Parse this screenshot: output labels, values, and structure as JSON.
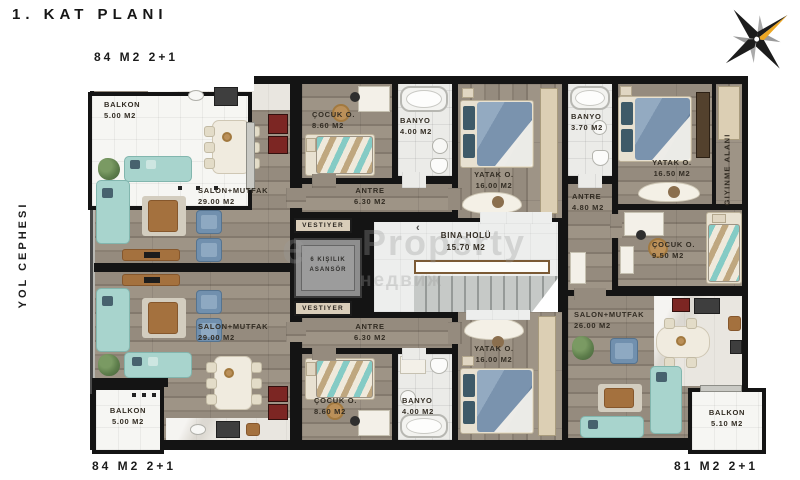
{
  "title": "1. KAT PLANI",
  "side_label": "YOL CEPHESI",
  "apartment_labels": {
    "top_left": "84 M2 2+1",
    "bottom_left": "84 M2 2+1",
    "bottom_right": "81 M2 2+1"
  },
  "core": {
    "vestiyer_top": "VESTIYER",
    "vestiyer_bottom": "VESTIYER",
    "elevator_line1": "6 KIŞILIK",
    "elevator_line2": "ASANSÖR",
    "hall_name": "BINA HOLÜ",
    "hall_area": "15.70 M2",
    "stairs_arrow": "‹"
  },
  "apt_84_top": {
    "balkon": {
      "name": "BALKON",
      "area": "5.00 M2"
    },
    "salon": {
      "name": "SALON+MUTFAK",
      "area": "29.00 M2"
    },
    "cocuk": {
      "name": "ÇOCUK O.",
      "area": "8.60 M2"
    },
    "banyo": {
      "name": "BANYO",
      "area": "4.00 M2"
    },
    "antre": {
      "name": "ANTRE",
      "area": "6.30 M2"
    },
    "yatak": {
      "name": "YATAK O.",
      "area": "16.00 M2"
    }
  },
  "apt_84_bottom": {
    "balkon": {
      "name": "BALKON",
      "area": "5.00 M2"
    },
    "salon": {
      "name": "SALON+MUTFAK",
      "area": "29.00 M2"
    },
    "cocuk": {
      "name": "ÇOCUK O.",
      "area": "8.60 M2"
    },
    "banyo": {
      "name": "BANYO",
      "area": "4.00 M2"
    },
    "antre": {
      "name": "ANTRE",
      "area": "6.30 M2"
    },
    "yatak": {
      "name": "YATAK O.",
      "area": "16.00 M2"
    }
  },
  "apt_81": {
    "yatak": {
      "name": "YATAK O.",
      "area": "16.50 M2"
    },
    "giyinme": {
      "name": "GIYINME ALANI"
    },
    "banyo": {
      "name": "BANYO",
      "area": "3.70 M2"
    },
    "antre": {
      "name": "ANTRE",
      "area": "4.80 M2"
    },
    "cocuk": {
      "name": "ÇOCUK O.",
      "area": "9.50 M2"
    },
    "salon": {
      "name": "SALON+MUTFAK",
      "area": "26.00 M2"
    },
    "balkon": {
      "name": "BALKON",
      "area": "5.10 M2"
    }
  },
  "watermark": {
    "glyph": "e",
    "text": "Property",
    "text2": "недвиж"
  },
  "colors": {
    "wall": "#141414",
    "wood": "#8f8578",
    "sofa_teal": "#a8d4cd",
    "furniture_blue": "#7190ae",
    "compass_orange": "#eda723"
  }
}
